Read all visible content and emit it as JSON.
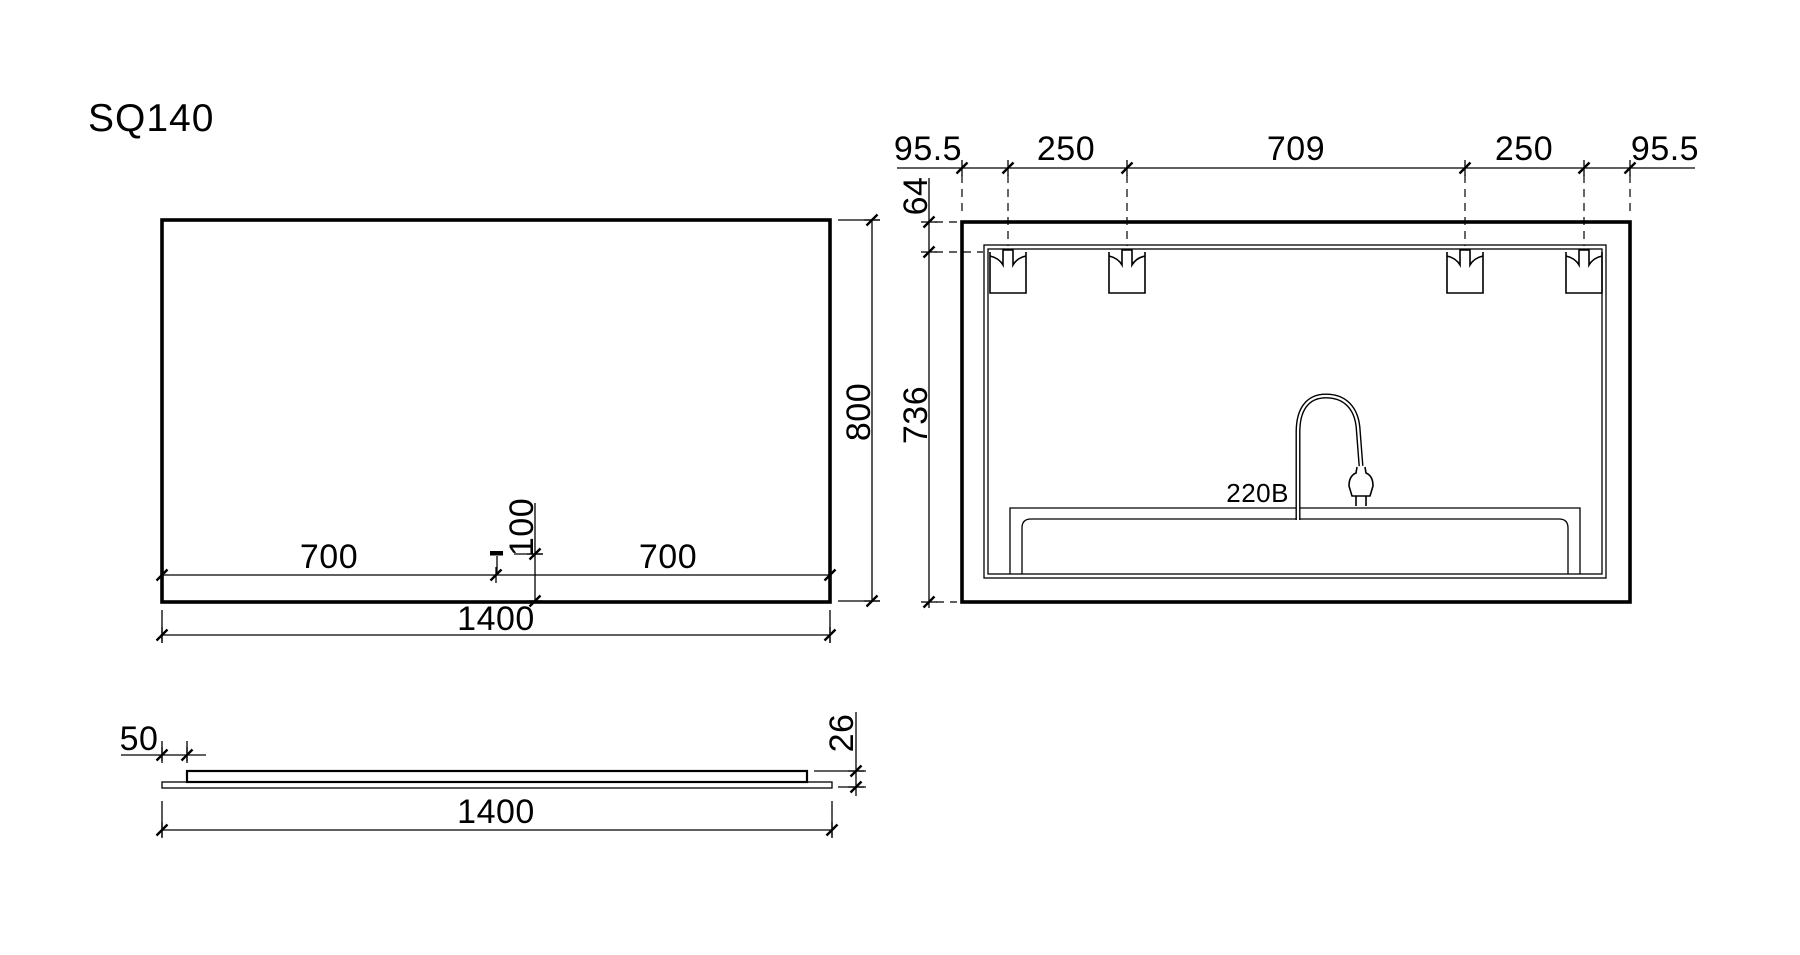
{
  "colors": {
    "ink": "#000000",
    "paper": "#ffffff"
  },
  "title": "SQ140",
  "front_view": {
    "bottom_left_dim": "700",
    "switch_height_dim": "100",
    "bottom_right_dim": "700",
    "width_dim": "1400",
    "height_dim": "800"
  },
  "rear_view": {
    "top_dims": [
      "95.5",
      "250",
      "709",
      "250",
      "95.5"
    ],
    "top_offset_dim": "64",
    "height_dim": "736",
    "power_label": "220B"
  },
  "side_view": {
    "inset_dim": "50",
    "thickness_dim": "26",
    "width_dim": "1400"
  }
}
